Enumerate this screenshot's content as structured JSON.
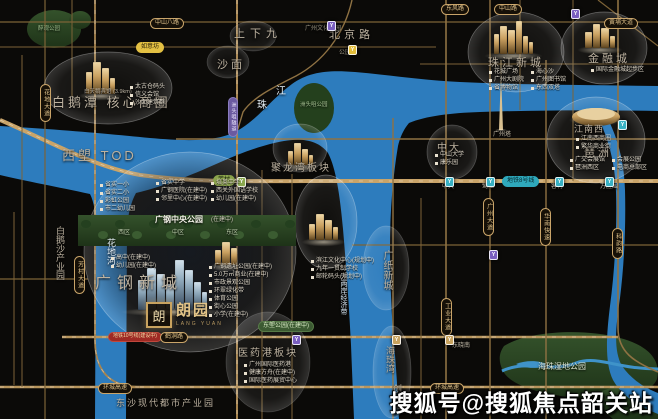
{
  "watermark": "搜狐号@搜狐焦点韶关站",
  "logo": {
    "seal": "朗",
    "name": "朗园",
    "sub": "LANG YUAN"
  },
  "colors": {
    "river": "#2d7cbd",
    "road_major": "#c9a469",
    "road_minor": "#7d6337",
    "park": "#2f4c28",
    "accent_gold": "#c9a35f"
  },
  "map": {
    "rivers": [
      {
        "d": "M0,126 C55,129 110,134 150,138 C185,141 215,142 235,132 C258,120 270,100 292,84 C310,71 330,70 355,72 C390,75 420,80 460,82 C520,85 590,85 658,86 L658,111 C600,110 540,110 480,112 C450,113 426,116 409,123 C403,130 400,138 398,146 C393,176 390,210 390,246 C390,286 392,324 395,355 C397,380 398,400 399,419 L354,419 C353,395 352,370 351,345 C349,305 346,264 343,229 C340,196 336,168 328,153 C318,140 302,138 284,141 C266,144 243,152 223,161 C196,173 166,186 136,193 C131,202 128,214 127,228 L126,419 L95,419 L96,228 C96,214 94,202 90,194 C58,187 25,181 0,175 Z"
      },
      {
        "d": "M604,112 C617,134 624,160 625,190 C626,228 624,266 620,298 C616,326 613,350 622,366 C632,380 645,388 658,393 L658,414 C638,406 622,396 613,380 C605,364 606,338 610,306 C615,268 617,228 616,192 C615,162 608,136 596,114 Z"
      }
    ],
    "streams": [
      {
        "d": "M502,371 C528,359 552,373 576,363 C598,355 616,369 658,369",
        "w": 3
      },
      {
        "d": "M516,364 C526,360 540,360 548,365 C540,369 524,369 516,364 Z",
        "w": 0,
        "fill": 1
      }
    ],
    "parks_under": [
      {
        "e": [
          54,
          29,
          27,
          19
        ]
      },
      {
        "e": [
          80,
          20,
          11,
          9
        ]
      },
      {
        "d": "M504,346 C528,331 584,328 620,338 C650,346 661,361 657,379 C650,397 612,402 576,398 C541,394 511,386 503,371 C498,361 499,353 504,346 Z"
      },
      {
        "d": "M602,391 C622,383 645,386 658,394 L658,419 L613,419 C601,410 597,399 602,391 Z"
      }
    ],
    "island": {
      "e": [
        314,
        108,
        20,
        25
      ]
    },
    "strip": {
      "r": [
        78,
        215,
        218,
        31
      ],
      "trees": {
        "x0": 86,
        "x1": 290,
        "step": 17,
        "y": 224,
        "dy": 11
      }
    },
    "roads": [
      {
        "d": "M0,22 H658",
        "w": 1.2,
        "c": "#7d6337"
      },
      {
        "d": "M0,47 H436",
        "w": 1.1,
        "c": "#7d6337"
      },
      {
        "d": "M420,64 H658",
        "w": 1,
        "c": "#7d6337"
      },
      {
        "d": "M176,139 H658",
        "w": 1.4,
        "c": "#8f7243"
      },
      {
        "d": "M0,120 C60,146 92,166 140,175 C200,183 250,181 310,181 L658,181",
        "w": 4,
        "c": "#c9a469",
        "dash": 1
      },
      {
        "d": "M352,245 H658",
        "w": 1.2,
        "c": "#7d6337"
      },
      {
        "d": "M0,279 H88",
        "w": 1.2,
        "c": "#7d6337"
      },
      {
        "d": "M62,337 H618",
        "w": 2.4,
        "c": "#b8955c",
        "dash": 1
      },
      {
        "d": "M0,387 H658",
        "w": 2.4,
        "c": "#b8955c",
        "dash": 1
      },
      {
        "d": "M352,0 C344,36 322,62 296,76 C272,88 252,98 243,112 L237,132",
        "w": 1.4,
        "c": "#8f7243"
      },
      {
        "d": "M22,55 V387",
        "w": 1,
        "c": "#7d6337"
      },
      {
        "d": "M45,0 V419",
        "w": 1.2,
        "c": "#7d6337"
      },
      {
        "d": "M72,0 V96",
        "w": 1,
        "c": "#7d6337"
      },
      {
        "d": "M95,0 V340 Q95,387 140,387",
        "w": 1.8,
        "c": "#a8854f",
        "dash": 1
      },
      {
        "d": "M237,0 V419",
        "w": 2,
        "c": "#a8854f",
        "dash": 1
      },
      {
        "d": "M262,170 V419",
        "w": 1,
        "c": "#7d6337"
      },
      {
        "d": "M292,174 V419",
        "w": 1,
        "c": "#7d6337"
      },
      {
        "d": "M393,118 V419",
        "w": 1.4,
        "c": "#8f7243"
      },
      {
        "d": "M421,198 V419",
        "w": 1,
        "c": "#7d6337"
      },
      {
        "d": "M446,0 V419",
        "w": 1.6,
        "c": "#8f7243"
      },
      {
        "d": "M490,0 V419",
        "w": 1.4,
        "c": "#8f7243"
      },
      {
        "d": "M520,0 V110",
        "w": 1,
        "c": "#7d6337"
      },
      {
        "d": "M546,60 V419",
        "w": 1.4,
        "c": "#8f7243"
      },
      {
        "d": "M573,0 V181",
        "w": 1,
        "c": "#7d6337"
      },
      {
        "d": "M618,0 V328 C618,352 634,362 658,372",
        "w": 1.6,
        "c": "#8f7243"
      },
      {
        "d": "M14,212 V385",
        "w": 1,
        "c": "#7d6337"
      },
      {
        "d": "M598,0 L658,46",
        "w": 1.2,
        "c": "#7d6337"
      }
    ],
    "bubbles": [
      {
        "e": [
          108,
          88,
          64,
          36
        ],
        "o": 1
      },
      {
        "e": [
          190,
          252,
          106,
          100
        ],
        "o": 1,
        "dark": 1
      },
      {
        "e": [
          300,
          148,
          27,
          24
        ],
        "o": 0.8
      },
      {
        "e": [
          326,
          222,
          31,
          47
        ],
        "o": 1
      },
      {
        "e": [
          516,
          52,
          48,
          40
        ],
        "o": 1
      },
      {
        "e": [
          604,
          48,
          43,
          36
        ],
        "o": 1
      },
      {
        "e": [
          596,
          140,
          49,
          43
        ],
        "o": 1
      },
      {
        "e": [
          452,
          152,
          25,
          27
        ],
        "o": 0.7
      },
      {
        "e": [
          228,
          62,
          21,
          16
        ],
        "o": 0.5
      },
      {
        "e": [
          253,
          36,
          23,
          15
        ],
        "o": 0.5
      },
      {
        "e": [
          268,
          362,
          42,
          50
        ],
        "o": 0.5
      },
      {
        "e": [
          392,
          372,
          19,
          46
        ],
        "o": 0.6
      },
      {
        "e": [
          386,
          268,
          23,
          42
        ],
        "o": 0.6
      }
    ],
    "towers": [
      {
        "x": 86,
        "y": 94,
        "f": "gold",
        "t": [
          [
            0,
            6,
            22
          ],
          [
            7,
            8,
            32
          ],
          [
            16,
            7,
            26
          ],
          [
            24,
            5,
            16
          ]
        ]
      },
      {
        "x": 288,
        "y": 165,
        "f": "gold",
        "t": [
          [
            0,
            5,
            14
          ],
          [
            6,
            7,
            22
          ],
          [
            14,
            6,
            16
          ],
          [
            21,
            4,
            10
          ]
        ]
      },
      {
        "x": 494,
        "y": 54,
        "f": "gold",
        "t": [
          [
            0,
            5,
            20
          ],
          [
            6,
            7,
            28
          ],
          [
            14,
            7,
            24
          ],
          [
            22,
            6,
            33
          ],
          [
            29,
            5,
            18
          ],
          [
            35,
            4,
            12
          ]
        ]
      },
      {
        "x": 585,
        "y": 48,
        "f": "gold",
        "t": [
          [
            0,
            7,
            16
          ],
          [
            8,
            7,
            24
          ],
          [
            16,
            8,
            20
          ],
          [
            25,
            5,
            12
          ]
        ]
      },
      {
        "x": 309,
        "y": 240,
        "f": "gold",
        "t": [
          [
            0,
            6,
            16
          ],
          [
            7,
            8,
            26
          ],
          [
            16,
            7,
            20
          ],
          [
            24,
            5,
            13
          ]
        ]
      },
      {
        "x": 215,
        "y": 265,
        "f": "gold",
        "t": [
          [
            0,
            6,
            15
          ],
          [
            7,
            8,
            23
          ],
          [
            16,
            6,
            17
          ]
        ]
      },
      {
        "x": 138,
        "y": 310,
        "f": "blue",
        "t": [
          [
            0,
            8,
            30
          ],
          [
            9,
            9,
            42
          ],
          [
            19,
            8,
            36
          ],
          [
            28,
            8,
            26
          ],
          [
            37,
            9,
            50
          ],
          [
            47,
            8,
            40
          ],
          [
            56,
            7,
            28
          ],
          [
            64,
            5,
            18
          ]
        ]
      }
    ],
    "disc": {
      "cx": 596,
      "cy": 117
    },
    "spire": {
      "x": 501,
      "top": 60,
      "base": 130
    },
    "labels": [
      {
        "t": "白鹅潭 核心商圈",
        "x": 52,
        "y": 96,
        "s": 13,
        "ls": 3
      },
      {
        "t": "西塱 TOD",
        "x": 62,
        "y": 149,
        "s": 13,
        "ls": 3
      },
      {
        "t": "上下九",
        "x": 234,
        "y": 29,
        "s": 11,
        "ls": 5
      },
      {
        "t": "沙面",
        "x": 217,
        "y": 60,
        "s": 11,
        "ls": 3
      },
      {
        "t": "北京路",
        "x": 329,
        "y": 30,
        "s": 11,
        "ls": 4
      },
      {
        "t": "广钢新城",
        "x": 95,
        "y": 276,
        "s": 16,
        "ls": 6
      },
      {
        "t": "聚龙湾板块",
        "x": 271,
        "y": 164,
        "s": 10,
        "ls": 2
      },
      {
        "t": "珠江新城",
        "x": 488,
        "y": 58,
        "s": 11,
        "ls": 3
      },
      {
        "t": "金融城",
        "x": 588,
        "y": 54,
        "s": 11,
        "ls": 3
      },
      {
        "t": "琶洲",
        "x": 584,
        "y": 148,
        "s": 11,
        "ls": 3
      },
      {
        "t": "中大",
        "x": 437,
        "y": 144,
        "s": 10,
        "ls": 2
      },
      {
        "t": "江南西",
        "x": 574,
        "y": 125,
        "s": 9,
        "ls": 1
      },
      {
        "t": "医药港板块",
        "x": 238,
        "y": 349,
        "s": 10,
        "ls": 2
      },
      {
        "t": "东沙现代都市产业园",
        "x": 116,
        "y": 399,
        "s": 9,
        "ls": 2
      },
      {
        "t": "广纸新城",
        "x": 379,
        "y": 250,
        "s": 10,
        "v": 1,
        "lh": 15
      },
      {
        "t": "海珠湾",
        "x": 384,
        "y": 346,
        "s": 9,
        "v": 1,
        "lh": 12
      },
      {
        "t": "创新港",
        "x": 391,
        "y": 384,
        "s": 9,
        "v": 1,
        "lh": 12
      },
      {
        "t": "白鹅沙产业园",
        "x": 54,
        "y": 226,
        "s": 9,
        "v": 1,
        "lh": 11
      },
      {
        "t": "广钢中央公园",
        "x": 155,
        "y": 216,
        "s": 8,
        "c": "#f2efe6",
        "b": 1
      },
      {
        "t": "(在建中)",
        "x": 211,
        "y": 217,
        "s": 6,
        "c": "#cfc9bb"
      },
      {
        "t": "西区",
        "x": 118,
        "y": 230,
        "s": 6,
        "c": "#b9c9a9"
      },
      {
        "t": "中区",
        "x": 172,
        "y": 230,
        "s": 6,
        "c": "#b9c9a9"
      },
      {
        "t": "东区",
        "x": 226,
        "y": 230,
        "s": 6,
        "c": "#b9c9a9"
      },
      {
        "t": "海珠湿地公园",
        "x": 538,
        "y": 363,
        "s": 8,
        "c": "#dfe7d2"
      },
      {
        "t": "洲头咀公园",
        "x": 300,
        "y": 103,
        "s": 5.5,
        "c": "#a8c294"
      },
      {
        "t": "醉观公园",
        "x": 38,
        "y": 27,
        "s": 5.5,
        "c": "#9fbd8c"
      },
      {
        "t": "广州塔",
        "x": 493,
        "y": 132,
        "s": 6,
        "c": "#c5bca9"
      },
      {
        "t": "花地河",
        "x": 98,
        "y": 238,
        "s": 9,
        "c": "#e6f0f7",
        "v": 1,
        "lh": 26
      },
      {
        "t": "珠",
        "x": 257,
        "y": 101,
        "s": 10,
        "c": "#e6f0f7"
      },
      {
        "t": "江",
        "x": 276,
        "y": 87,
        "s": 10,
        "c": "#e6f0f7"
      },
      {
        "t": "一江两岸经济带",
        "x": 339,
        "y": 266,
        "s": 7,
        "c": "#d5e4f0",
        "v": 1,
        "lh": 9
      },
      {
        "t": "广州文化公园",
        "x": 305,
        "y": 26,
        "s": 6,
        "c": "#97917f"
      },
      {
        "t": "公园前",
        "x": 339,
        "y": 50,
        "s": 6,
        "c": "#97917f"
      },
      {
        "t": "中大",
        "x": 442,
        "y": 184,
        "s": 6,
        "c": "#c8c0ae"
      },
      {
        "t": "鹭江",
        "x": 482,
        "y": 184,
        "s": 6,
        "c": "#c8c0ae"
      },
      {
        "t": "客村",
        "x": 551,
        "y": 184,
        "s": 6,
        "c": "#c8c0ae"
      },
      {
        "t": "万胜围",
        "x": 600,
        "y": 184,
        "s": 6,
        "c": "#c8c0ae"
      },
      {
        "t": "东晓南",
        "x": 452,
        "y": 343,
        "s": 6,
        "c": "#c8c0ae"
      },
      {
        "t": "白天鹅宾馆 (3.9km)",
        "x": 84,
        "y": 90,
        "s": 5.5,
        "c": "#b9b0a0"
      }
    ],
    "pills": [
      {
        "t": "中山八路",
        "x": 150,
        "y": 18,
        "k": "g"
      },
      {
        "t": "东风路",
        "x": 441,
        "y": 4,
        "k": "g"
      },
      {
        "t": "中山路",
        "x": 494,
        "y": 4,
        "k": "g"
      },
      {
        "t": "黄埔大道",
        "x": 604,
        "y": 18,
        "k": "g"
      },
      {
        "t": "如意坊",
        "x": 136,
        "y": 42,
        "k": "y"
      },
      {
        "t": "芳村",
        "x": 213,
        "y": 175,
        "k": "gr"
      },
      {
        "t": "洲头咀隧道",
        "x": 228,
        "y": 97,
        "k": "p",
        "v": 1
      },
      {
        "t": "花地大道",
        "x": 40,
        "y": 84,
        "k": "g",
        "v": 1
      },
      {
        "t": "芳村大道",
        "x": 74,
        "y": 256,
        "k": "g",
        "v": 1
      },
      {
        "t": "地铁10号线(建设中)",
        "x": 108,
        "y": 332,
        "k": "r"
      },
      {
        "t": "鹤洞路",
        "x": 160,
        "y": 332,
        "k": "g"
      },
      {
        "t": "环城高速",
        "x": 98,
        "y": 383,
        "k": "g"
      },
      {
        "t": "环城高速",
        "x": 430,
        "y": 383,
        "k": "g"
      },
      {
        "t": "地铁8号线",
        "x": 502,
        "y": 176,
        "k": "c"
      },
      {
        "t": "广州大道",
        "x": 483,
        "y": 198,
        "k": "g",
        "v": 1
      },
      {
        "t": "工业大道",
        "x": 441,
        "y": 298,
        "k": "g",
        "v": 1
      },
      {
        "t": "华南快速",
        "x": 540,
        "y": 208,
        "k": "g",
        "v": 1
      },
      {
        "t": "科韵路",
        "x": 612,
        "y": 228,
        "k": "g",
        "v": 1
      },
      {
        "t": "东塱公园(在建中)",
        "x": 258,
        "y": 321,
        "k": "pl"
      }
    ],
    "stations": [
      {
        "x": 327,
        "y": 21,
        "c": "#7a5fc0"
      },
      {
        "x": 348,
        "y": 45,
        "c": "#e3bd3a"
      },
      {
        "x": 237,
        "y": 177,
        "c": "#8aa84e"
      },
      {
        "x": 445,
        "y": 177,
        "c": "#38b1c4"
      },
      {
        "x": 486,
        "y": 177,
        "c": "#38b1c4"
      },
      {
        "x": 555,
        "y": 177,
        "c": "#38b1c4"
      },
      {
        "x": 605,
        "y": 177,
        "c": "#38b1c4"
      },
      {
        "x": 571,
        "y": 9,
        "c": "#7a5fc0"
      },
      {
        "x": 292,
        "y": 335,
        "c": "#7a5fc0"
      },
      {
        "x": 445,
        "y": 335,
        "c": "#c8a35f"
      },
      {
        "x": 392,
        "y": 335,
        "c": "#c8a35f"
      },
      {
        "x": 489,
        "y": 250,
        "c": "#7a5fc0"
      },
      {
        "x": 618,
        "y": 120,
        "c": "#38b1c4"
      }
    ],
    "bullets": [
      {
        "x": 130,
        "y": 84,
        "cols": [
          [
            "太古仓码头",
            "信义会馆",
            "沙面建筑群"
          ]
        ]
      },
      {
        "x": 100,
        "y": 182,
        "cols": [
          [
            "省实一小",
            "省实二小",
            "彩虹公园",
            "市二幼儿园"
          ]
        ]
      },
      {
        "x": 156,
        "y": 180,
        "cols": [
          [
            "省实中学",
            "广钢医院(在建中)",
            "邻里中心(在建中)"
          ]
        ]
      },
      {
        "x": 211,
        "y": 180,
        "cols": [
          [
            "培英中学",
            "西关外国语学校",
            "幼儿园(在建中)"
          ]
        ]
      },
      {
        "x": 111,
        "y": 255,
        "cols": [
          [
            "高中(在建中)",
            "幼儿园(在建中)"
          ]
        ]
      },
      {
        "x": 209,
        "y": 264,
        "cols": [
          [
            "广钢遗址公园(在建中)",
            "5.0万㎡商业(在建中)",
            "市政景观公园",
            "环翠绿化带",
            "体育公园",
            "街心公园",
            "小学(在建中)"
          ]
        ]
      },
      {
        "x": 311,
        "y": 258,
        "cols": [
          [
            "滨江文化中心(规划中)",
            "九年一贯制学校",
            "邮轮码头(规划中)"
          ]
        ]
      },
      {
        "x": 489,
        "y": 69,
        "cols": [
          [
            "花城广场",
            "广州大剧院",
            "省博物馆"
          ],
          [
            "海心沙",
            "广州图书馆",
            "东西双塔"
          ]
        ]
      },
      {
        "x": 591,
        "y": 67,
        "cols": [
          [
            "国际金融城起步区"
          ]
        ]
      },
      {
        "x": 570,
        "y": 157,
        "cols": [
          [
            "广交会展馆",
            "琶洲西区"
          ],
          [
            "会展公园",
            "电商总部区"
          ]
        ]
      },
      {
        "x": 435,
        "y": 152,
        "cols": [
          [
            "中山大学",
            "康乐园"
          ]
        ]
      },
      {
        "x": 576,
        "y": 136,
        "cols": [
          [
            "江南西商圈",
            "繁华商业街"
          ]
        ]
      },
      {
        "x": 244,
        "y": 362,
        "cols": [
          [
            "广州国际医药港",
            "健康方舟(在建中)",
            "国际医药展贸中心"
          ]
        ]
      }
    ]
  }
}
